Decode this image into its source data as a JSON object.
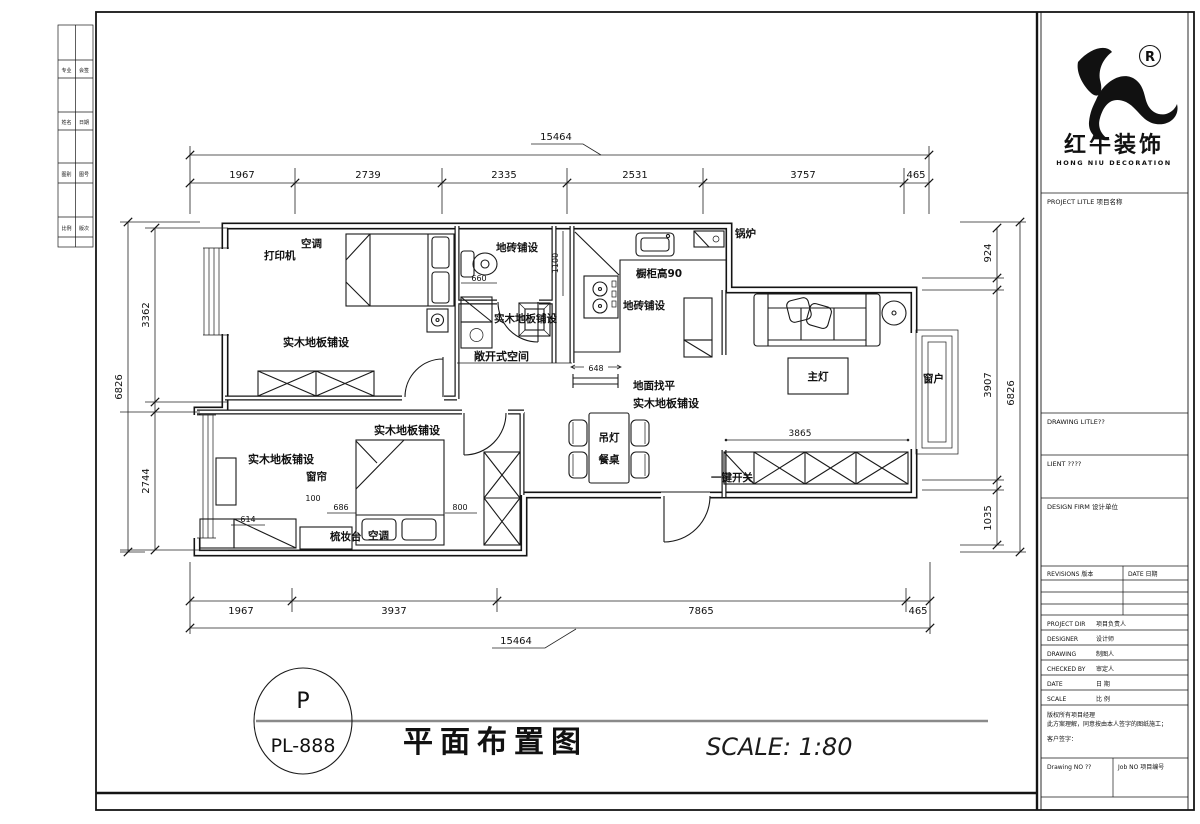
{
  "logo": {
    "cn": "红牛装饰",
    "en": "HONG NIU DECORATION",
    "reg": "R"
  },
  "panel": {
    "project_title": "PROJECT LITLE 项目名称",
    "drawing_title": "DRAWING LITLE??",
    "client": "LIENT ????",
    "design_firm": "DESIGN FIRM 设计单位",
    "revisions": "REVISIONS 版本",
    "date_col": "DATE 日期",
    "fields": [
      {
        "en": "PROJECT DIR",
        "cn": "项目负责人"
      },
      {
        "en": "DESIGNER",
        "cn": "设计师"
      },
      {
        "en": "DRAWING",
        "cn": "制图人"
      },
      {
        "en": "CHECKED BY",
        "cn": "审定人"
      },
      {
        "en": "DATE",
        "cn": "日 期"
      },
      {
        "en": "SCALE",
        "cn": "比 例"
      }
    ],
    "note_line1": "版权所有项目经理",
    "note_line2": "此方案理解，同意按由本人签字的图纸施工；",
    "note_line3": "客户签字：",
    "drawing_no": "Drawing NO ??",
    "job_no": "Job NO 项目编号"
  },
  "titlebar": {
    "tag_top": "P",
    "tag_bottom": "PL-888",
    "title": "平面布置图",
    "scale": "SCALE: 1:80"
  },
  "strip": {
    "r0c0": "专业",
    "r0c1": "会签",
    "r1c0": "姓名",
    "r1c1": "日期",
    "r2c0": "图别",
    "r2c1": "图号",
    "r3c0": "比例",
    "r3c1": "版次"
  },
  "dims": {
    "top_total": "15464",
    "top_1": "1967",
    "top_2": "2739",
    "top_3": "2335",
    "top_4": "2531",
    "top_5": "3757",
    "top_6": "465",
    "bottom_total": "15464",
    "bottom_1": "1967",
    "bottom_2": "3937",
    "bottom_3": "7865",
    "bottom_4": "465",
    "left_total": "6826",
    "left_1": "3362",
    "left_2": "2744",
    "right_total": "6826",
    "right_1": "924",
    "right_2": "3907",
    "right_3": "1035",
    "d660": "660",
    "d1100": "1100",
    "d648": "648",
    "d3865": "3865",
    "d100": "100",
    "d686": "686",
    "d614": "614",
    "d800": "800"
  },
  "labels": {
    "study_printer": "打印机",
    "study_ac": "空调",
    "study_floor": "实木地板铺设",
    "bath_tile": "地砖铺设",
    "laundry_floor": "实木地板铺设",
    "open_space": "敞开式空间",
    "kitchen_cabinet": "橱柜高90",
    "kitchen_tile": "地砖铺设",
    "boiler": "锅炉",
    "living_light": "主灯",
    "living_window": "窗户",
    "switch": "一键开关",
    "dining_pendant": "吊灯",
    "dining_table": "餐桌",
    "floor_level": "地面找平",
    "hall_floor": "实木地板铺设",
    "bed2_floor_top": "实木地板铺设",
    "bed2_floor": "实木地板铺设",
    "curtain": "窗帘",
    "dresser": "梳妆台",
    "bed2_ac": "空调"
  }
}
